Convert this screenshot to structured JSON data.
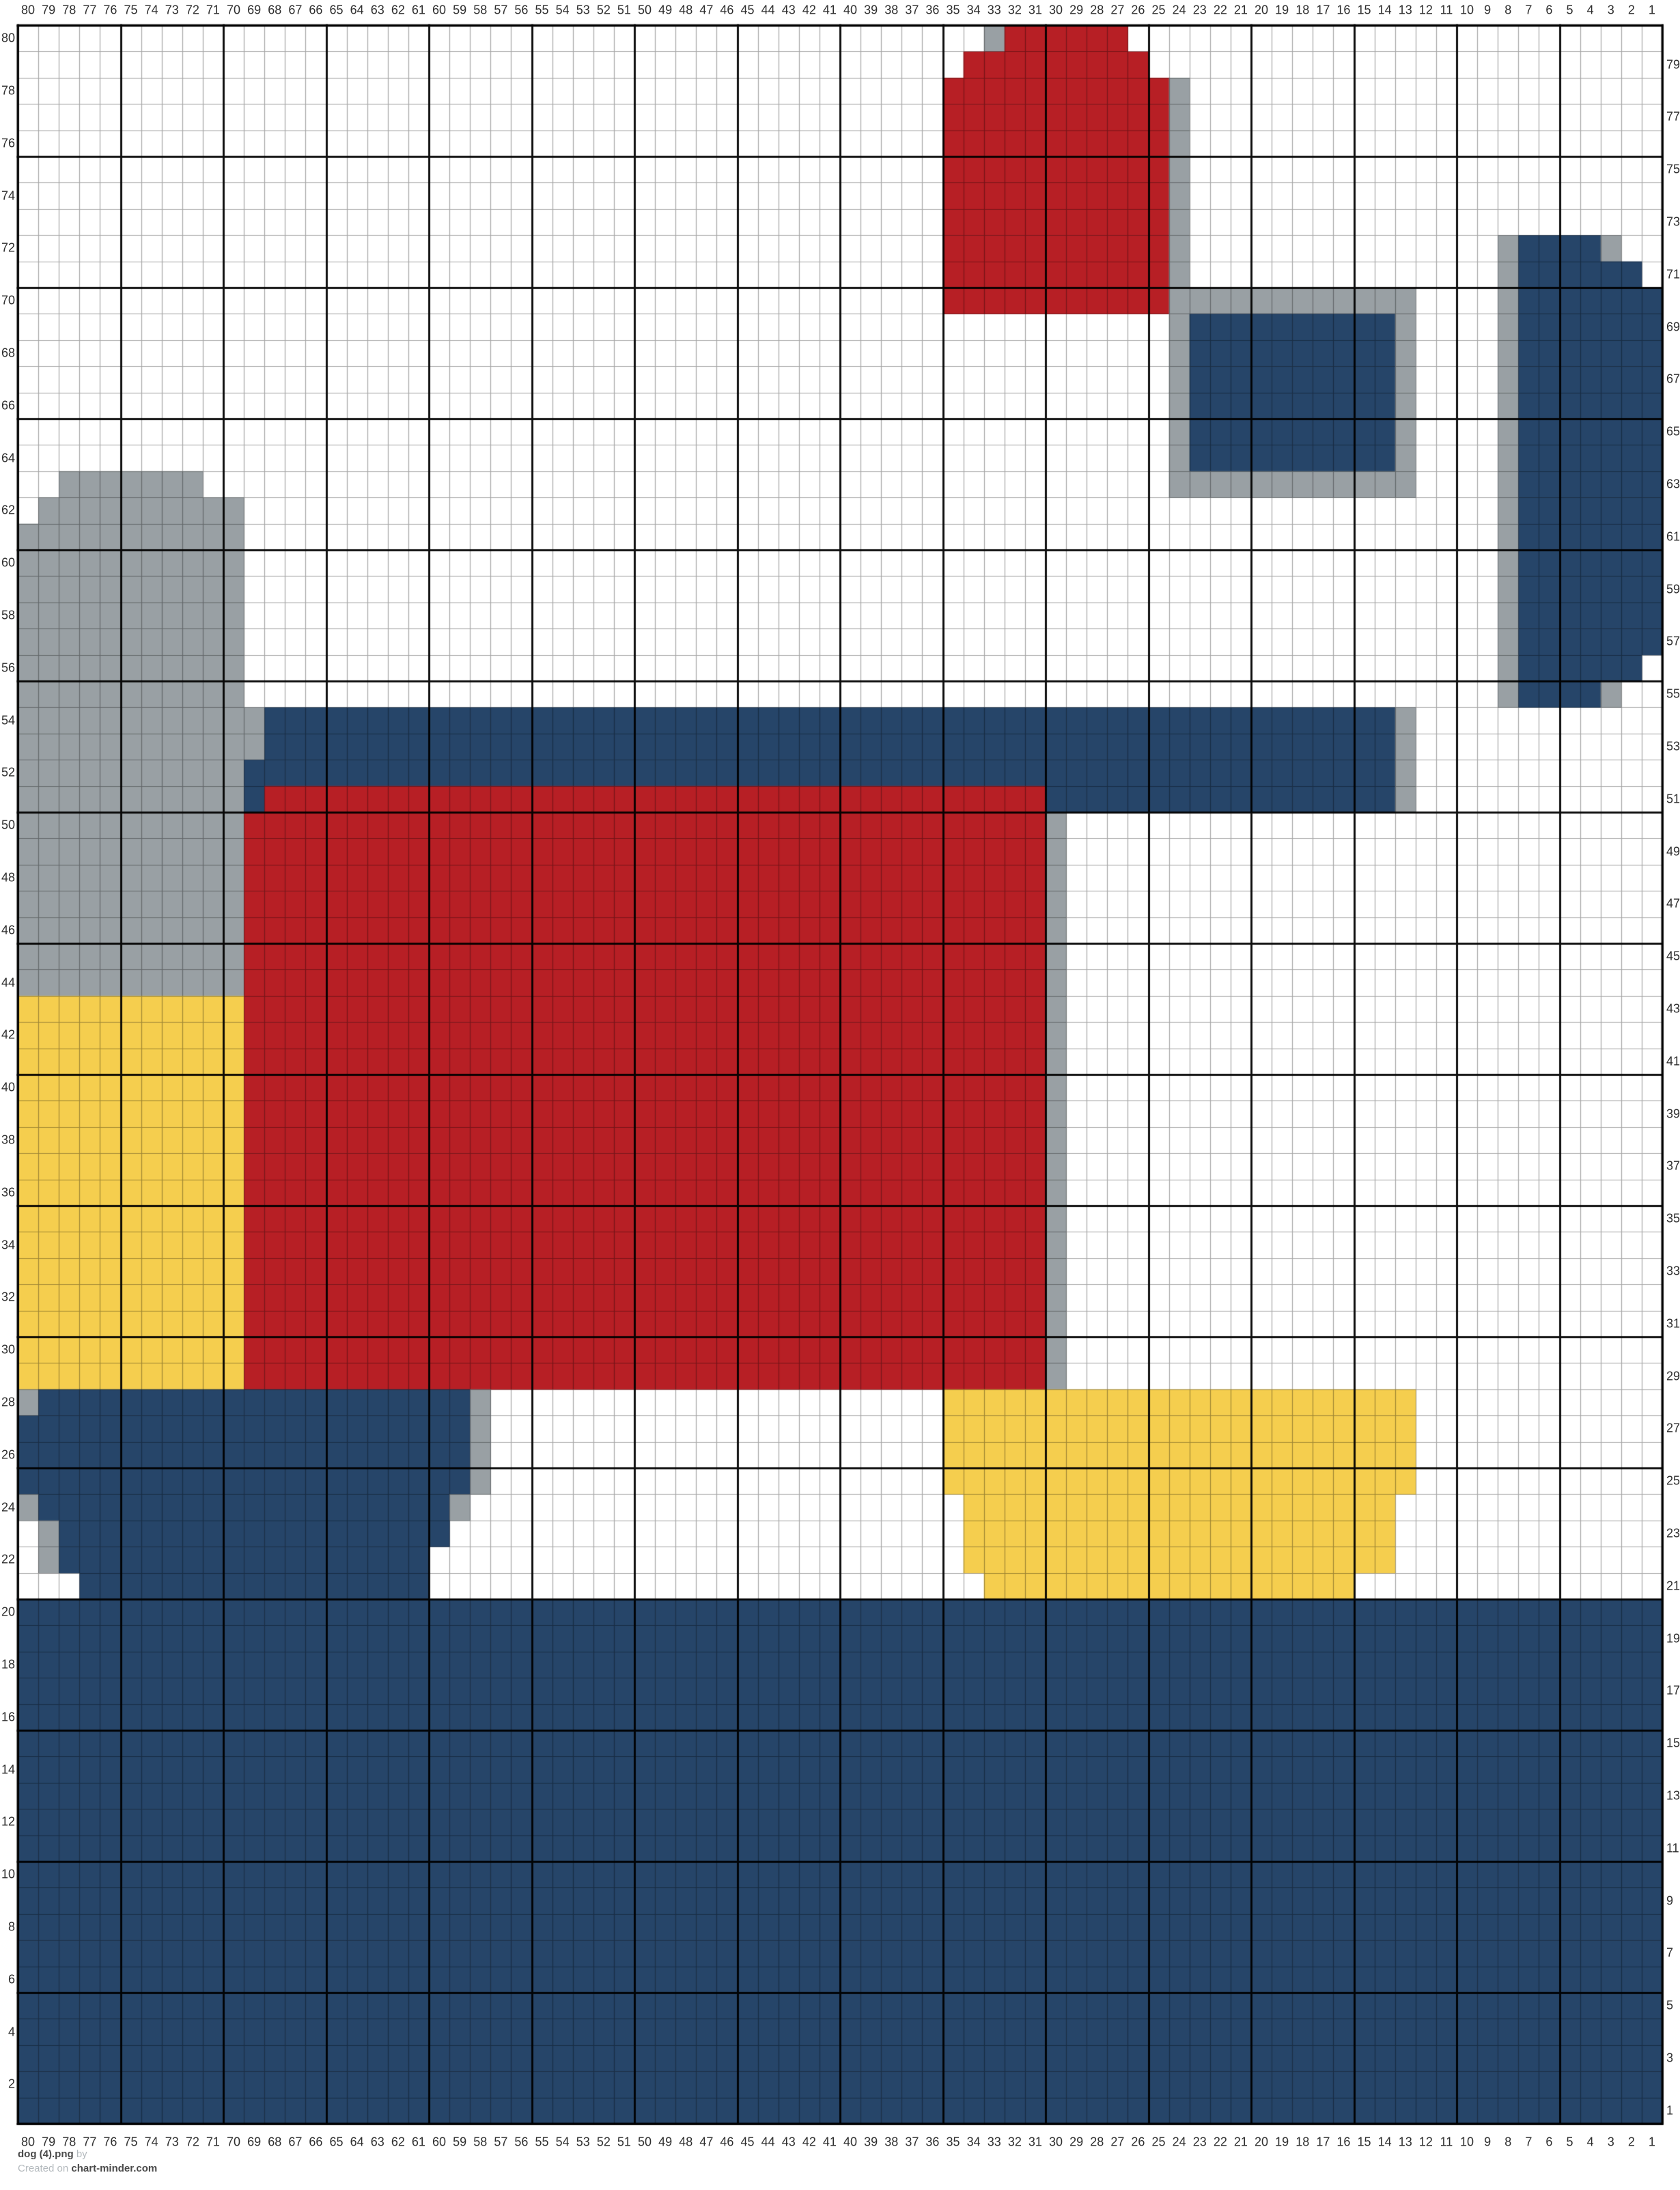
{
  "footer": {
    "title": "dog (4).png",
    "by_label": "by",
    "created_label": "Created on",
    "site": "chart-minder.com"
  },
  "colors": {
    "background": "#ffffff",
    "navy": "#264569",
    "red": "#B71F25",
    "yellow": "#F5CE4E",
    "gray": "#99A0A4",
    "grid_line": "rgba(0,0,0,0.35)",
    "grid_line_bold": "rgba(0,0,0,0.92)",
    "label_text": "#2e2e2e"
  },
  "axis_labels": {
    "top": [
      80,
      79,
      78,
      77,
      76,
      75,
      74,
      73,
      72,
      71,
      70,
      69,
      68,
      67,
      66,
      65,
      64,
      63,
      62,
      61,
      60,
      59,
      58,
      57,
      56,
      55,
      54,
      53,
      52,
      51,
      50,
      49,
      48,
      47,
      46,
      45,
      44,
      43,
      42,
      41,
      40,
      39,
      38,
      37,
      36,
      35,
      34,
      33,
      32,
      31,
      30,
      29,
      28,
      27,
      26,
      25,
      24,
      23,
      22,
      21,
      20,
      19,
      18,
      17,
      16,
      15,
      14,
      13,
      12,
      11,
      10,
      9,
      8,
      7,
      6,
      5,
      4,
      3,
      2,
      1
    ],
    "bottom": [
      80,
      79,
      78,
      77,
      76,
      75,
      74,
      73,
      72,
      71,
      70,
      69,
      68,
      67,
      66,
      65,
      64,
      63,
      62,
      61,
      60,
      59,
      58,
      57,
      56,
      55,
      54,
      53,
      52,
      51,
      50,
      49,
      48,
      47,
      46,
      45,
      44,
      43,
      42,
      41,
      40,
      39,
      38,
      37,
      36,
      35,
      34,
      33,
      32,
      31,
      30,
      29,
      28,
      27,
      26,
      25,
      24,
      23,
      22,
      21,
      20,
      19,
      18,
      17,
      16,
      15,
      14,
      13,
      12,
      11,
      10,
      9,
      8,
      7,
      6,
      5,
      4,
      3,
      2,
      1
    ],
    "left_even": [
      80,
      78,
      76,
      74,
      72,
      70,
      68,
      66,
      64,
      62,
      60,
      58,
      56,
      54,
      52,
      50,
      48,
      46,
      44,
      42,
      40,
      38,
      36,
      34,
      32,
      30,
      28,
      26,
      24,
      22,
      20,
      18,
      16,
      14,
      12,
      10,
      8,
      6,
      4,
      2
    ],
    "right_odd": [
      79,
      77,
      75,
      73,
      71,
      69,
      67,
      65,
      63,
      61,
      59,
      57,
      55,
      53,
      51,
      49,
      47,
      45,
      43,
      41,
      39,
      37,
      35,
      33,
      31,
      29,
      27,
      25,
      23,
      21,
      19,
      17,
      15,
      13,
      11,
      9,
      7,
      5,
      3,
      1
    ]
  },
  "chart_data": {
    "type": "heatmap",
    "title": "dog (4).png",
    "grid": {
      "columns": 80,
      "rows": 80,
      "column_numbering": "80 to 1, left to right",
      "row_numbering": "80 to 1, top to bottom",
      "bold_line_every": 5
    },
    "legend": {
      ".": "white",
      "N": "navy",
      "R": "red",
      "Y": "yellow",
      "G": "gray"
    },
    "rows_rle": [
      "47. 1G 6R 26.",
      "46. 9R 25.",
      "45. 11R 1G 23.",
      "45. 11R 1G 23.",
      "45. 11R 1G 23.",
      "45. 11R 1G 23.",
      "45. 11R 1G 23.",
      "45. 11R 1G 23.",
      "45. 11R 1G 15. 1G 4N 1G 2.",
      "45. 11R 1G 15. 1G 6N 1.",
      "45. 11R 12G 4. 1G 7N",
      "56. 1G 10N 1G 4. 1G 7N",
      "56. 1G 10N 1G 4. 1G 7N",
      "56. 1G 10N 1G 4. 1G 7N",
      "56. 1G 10N 1G 4. 1G 7N",
      "56. 1G 10N 1G 4. 1G 7N",
      "56. 1G 10N 1G 4. 1G 7N",
      "2. 7G 47. 12G 4. 1G 7N",
      "1. 10G 61. 1G 7N",
      "11G 61. 1G 7N",
      "11G 61. 1G 7N",
      "11G 61. 1G 7N",
      "11G 61. 1G 7N",
      "11G 61. 1G 7N",
      "11G 61. 1G 6N 1.",
      "11G 61. 1G 4N 1G 2.",
      "12G 55N 1G 12.",
      "12G 55N 1G 12.",
      "11G 56N 1G 12.",
      "11G 1N 38R 17N 1G 12.",
      "11G 39R 1G 29.",
      "11G 39R 1G 29.",
      "11G 39R 1G 29.",
      "11G 39R 1G 29.",
      "11G 39R 1G 29.",
      "11G 39R 1G 29.",
      "11G 39R 1G 29.",
      "11Y 39R 1G 29.",
      "11Y 39R 1G 29.",
      "11Y 39R 1G 29.",
      "11Y 39R 1G 29.",
      "11Y 39R 1G 29.",
      "11Y 39R 1G 29.",
      "11Y 39R 1G 29.",
      "11Y 39R 1G 29.",
      "11Y 39R 1G 29.",
      "11Y 39R 1G 29.",
      "11Y 39R 1G 29.",
      "11Y 39R 1G 29.",
      "11Y 39R 1G 29.",
      "11Y 39R 1G 29.",
      "11Y 39R 1G 29.",
      "1G 21N 1G 22. 23Y 12.",
      "22N 1G 22. 23Y 12.",
      "22N 1G 22. 23Y 12.",
      "22N 1G 22. 23Y 12.",
      "1G 20N 1G 24. 21Y 13.",
      "1. 1G 19N 25. 21Y 13.",
      "1. 1G 18N 26. 21Y 13.",
      "3. 17N 27. 18Y 15.",
      "80N",
      "80N",
      "80N",
      "80N",
      "80N",
      "80N",
      "80N",
      "80N",
      "80N",
      "80N",
      "80N",
      "80N",
      "80N",
      "80N",
      "80N",
      "80N",
      "80N",
      "80N",
      "80N",
      "80N"
    ]
  }
}
